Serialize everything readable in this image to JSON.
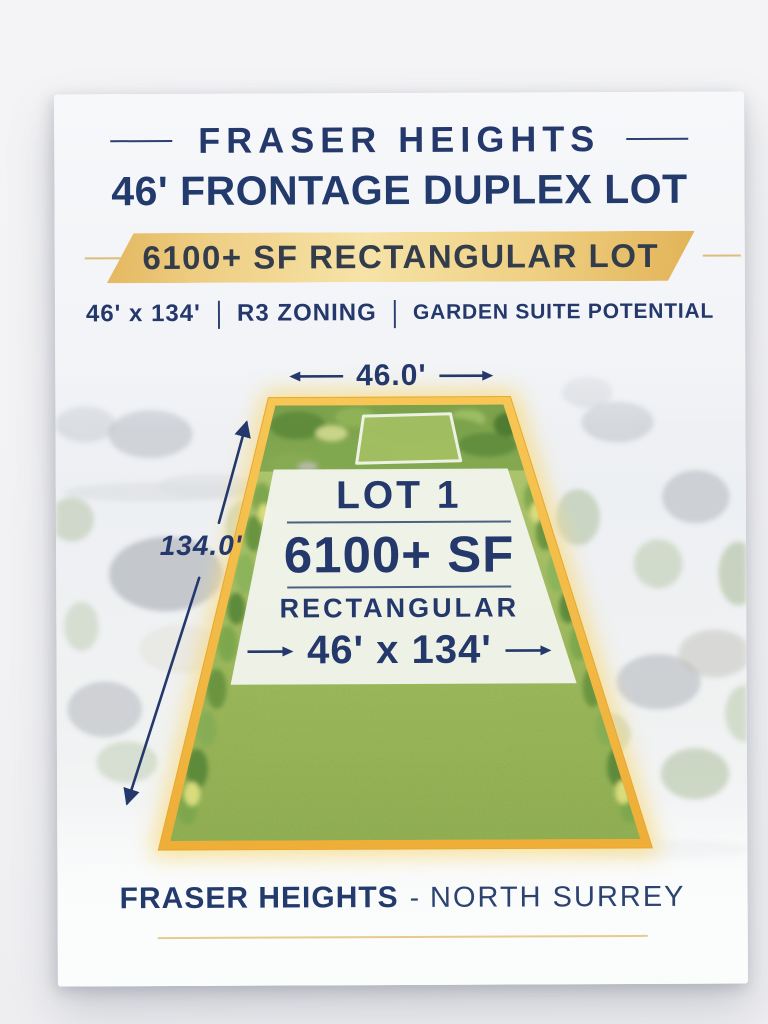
{
  "header": {
    "title": "FRASER HEIGHTS",
    "subtitle": "46' FRONTAGE DUPLEX LOT",
    "banner": "6100+ SF RECTANGULAR LOT"
  },
  "specs": {
    "dimensions": "46' x 134'",
    "separator": "|",
    "zoning": "R3 ZONING",
    "feature": "GARDEN SUITE POTENTIAL"
  },
  "diagram": {
    "frontage": "46.0'",
    "depth": "134.0'",
    "lot_label": "LOT 1",
    "lot_size": "6100+ SF",
    "lot_shape": "RECTANGULAR",
    "lot_dimensions": "46' x 134'"
  },
  "footer": {
    "area": "FRASER HEIGHTS",
    "separator": "-",
    "city": "NORTH SURREY"
  },
  "colors": {
    "navy_text": "#24386B",
    "gold_border": "#F2B94B",
    "banner_gold": "#F3DD9E",
    "grass_green": "#98B556",
    "panel_white": "#F3F5EF",
    "page_background": "#F3F3F5"
  }
}
